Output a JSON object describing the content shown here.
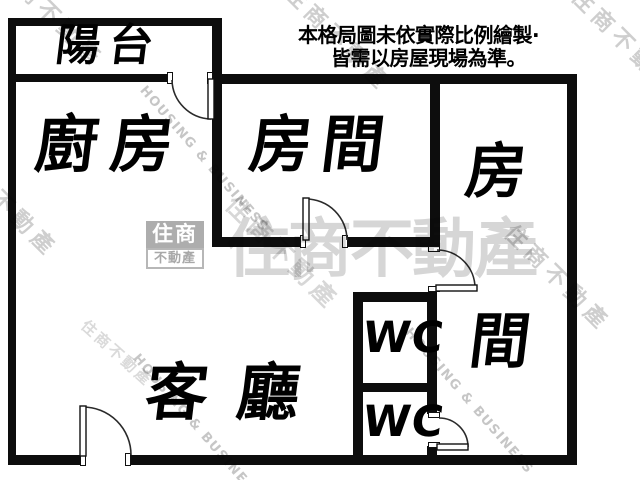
{
  "disclaimer": {
    "line1": "本格局圖未依實際比例繪製·",
    "line2": "皆需以房屋現場為準。"
  },
  "rooms": {
    "balcony": "陽台",
    "kitchen": "廚房",
    "bedroom_top": "房間",
    "bedroom_right_char1": "房",
    "bedroom_right_char2": "間",
    "living": "客 廳",
    "wc_upper": "WC",
    "wc_lower": "WC"
  },
  "watermark": {
    "brand_cn": "住商不動產",
    "brand_en": "HOUSING & BUSINESS",
    "logo_top": "住商",
    "logo_bottom": "不動產"
  },
  "colors": {
    "wall": "#0d0d0d",
    "label_text": "#000000",
    "watermark_gray": "#c3c3c3",
    "logo_gray": "#a9a9a9"
  }
}
